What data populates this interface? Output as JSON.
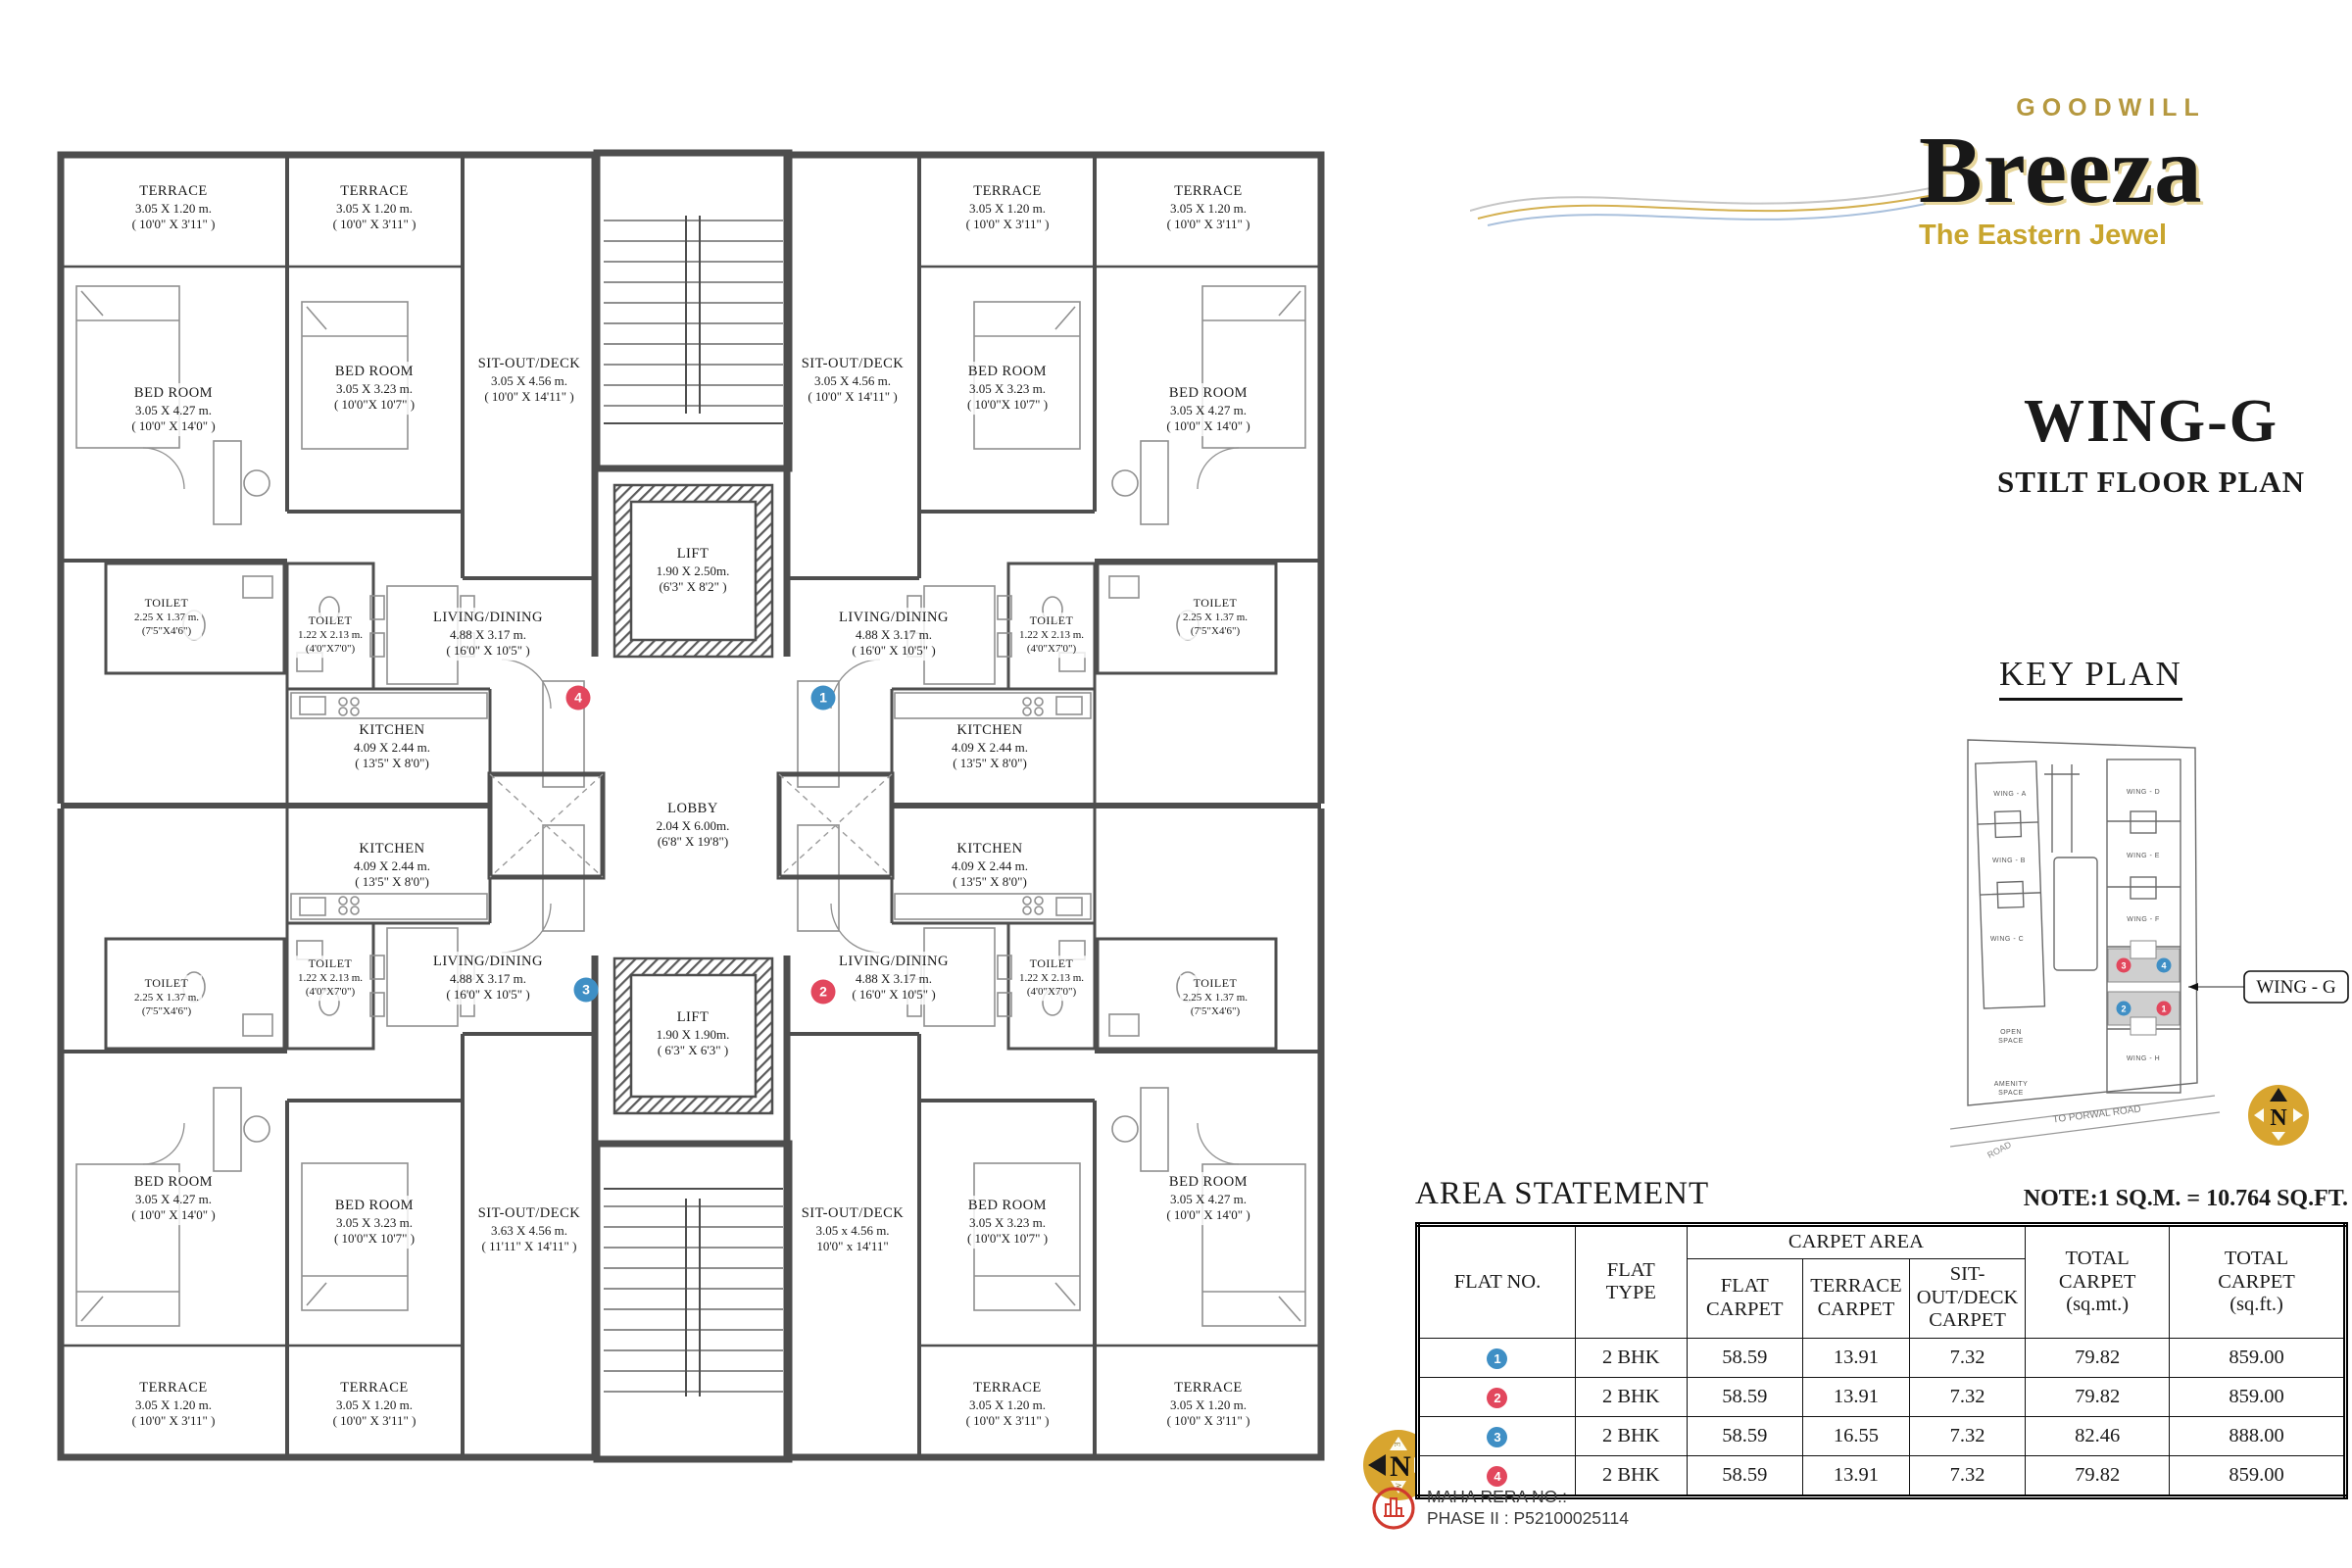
{
  "branding": {
    "goodwill": "GOODWILL",
    "name": "Breeza",
    "tagline": "The Eastern Jewel"
  },
  "titles": {
    "wing": "WING-G",
    "subtitle": "STILT FLOOR PLAN"
  },
  "key_plan": {
    "title": "KEY PLAN",
    "callout": "WING - G",
    "wings": {
      "a": "WING - A",
      "b": "WING - B",
      "c": "WING - C",
      "d": "WING - D",
      "e": "WING - E",
      "f": "WING - F",
      "h": "WING - H"
    },
    "open_space_1": "OPEN",
    "open_space_2": "SPACE",
    "amenity_1": "AMENITY",
    "amenity_2": "SPACE",
    "to_road": "TO PORWAL ROAD",
    "road": "ROAD",
    "compass_n": "N"
  },
  "floor_plan": {
    "rooms": {
      "terrace": {
        "name": "TERRACE",
        "m": "3.05 X 1.20 m.",
        "ft": "( 10'0\" X 3'11\" )"
      },
      "bedroom_l": {
        "name": "BED ROOM",
        "m": "3.05  X 4.27 m.",
        "ft": "( 10'0\" X 14'0\" )"
      },
      "bedroom_s": {
        "name": "BED ROOM",
        "m": "3.05 X 3.23 m.",
        "ft": "( 10'0\"X 10'7\" )"
      },
      "toilet_l": {
        "name": "TOILET",
        "m": "2.25 X 1.37 m.",
        "ft": "(7'5\"X4'6\")"
      },
      "toilet_s": {
        "name": "TOILET",
        "m": "1.22 X 2.13 m.",
        "ft": "(4'0\"X7'0\")"
      },
      "living": {
        "name": "LIVING/DINING",
        "m": "4.88 X 3.17 m.",
        "ft": "( 16'0\" X 10'5\" )"
      },
      "kitchen": {
        "name": "KITCHEN",
        "m": "4.09 X 2.44 m.",
        "ft": "( 13'5\" X 8'0\")"
      },
      "sitout": {
        "name": "SIT-OUT/DECK",
        "m": "3.05 X 4.56 m.",
        "ft": "( 10'0\" X 14'11\" )"
      },
      "sitout_bl": {
        "name": "SIT-OUT/DECK",
        "m": "3.63 X 4.56 m.",
        "ft": "( 11'11\" X 14'11\" )"
      },
      "sitout_br": {
        "name": "SIT-OUT/DECK",
        "m": "3.05 x 4.56 m.",
        "ft": "10'0\" x 14'11\""
      },
      "lift_top": {
        "name": "LIFT",
        "m": "1.90 X 2.50m.",
        "ft": "(6'3\" X 8'2\" )"
      },
      "lift_bot": {
        "name": "LIFT",
        "m": "1.90 X 1.90m.",
        "ft": "( 6'3\" X 6'3\" )"
      },
      "lobby": {
        "name": "LOBBY",
        "m": "2.04 X 6.00m.",
        "ft": "(6'8\" X 19'8\")"
      }
    },
    "markers": {
      "m1": "1",
      "m2": "2",
      "m3": "3",
      "m4": "4"
    },
    "compass": {
      "n": "N",
      "e": "E",
      "s": "S",
      "w": "W"
    }
  },
  "area_statement": {
    "title": "AREA STATEMENT",
    "note": "NOTE:1 SQ.M. = 10.764 SQ.FT.",
    "headers": {
      "flat_no": "FLAT NO.",
      "flat_type_1": "FLAT",
      "flat_type_2": "TYPE",
      "carpet_area": "CARPET AREA",
      "flat_carpet_1": "FLAT",
      "flat_carpet_2": "CARPET",
      "terrace_carpet_1": "TERRACE",
      "terrace_carpet_2": "CARPET",
      "sitout_carpet_1": "SIT-OUT/DECK",
      "sitout_carpet_2": "CARPET",
      "total_mt_1": "TOTAL",
      "total_mt_2": "CARPET",
      "total_mt_3": "(sq.mt.)",
      "total_ft_1": "TOTAL",
      "total_ft_2": "CARPET",
      "total_ft_3": "(sq.ft.)"
    },
    "rows": [
      {
        "no": "1",
        "type": "2 BHK",
        "flat": "58.59",
        "terrace": "13.91",
        "sitout": "7.32",
        "total_mt": "79.82",
        "total_ft": "859.00"
      },
      {
        "no": "2",
        "type": "2 BHK",
        "flat": "58.59",
        "terrace": "13.91",
        "sitout": "7.32",
        "total_mt": "79.82",
        "total_ft": "859.00"
      },
      {
        "no": "3",
        "type": "2 BHK",
        "flat": "58.59",
        "terrace": "16.55",
        "sitout": "7.32",
        "total_mt": "82.46",
        "total_ft": "888.00"
      },
      {
        "no": "4",
        "type": "2 BHK",
        "flat": "58.59",
        "terrace": "13.91",
        "sitout": "7.32",
        "total_mt": "79.82",
        "total_ft": "859.00"
      }
    ]
  },
  "rera": {
    "line1": "MAHA RERA  NO.:",
    "line2": "PHASE II : P52100025114"
  },
  "colors": {
    "marker_blue": "#3f8fc5",
    "marker_red": "#e2475d",
    "gold": "#c9a13b",
    "wall": "#4e4e4e",
    "keyplan_highlight": "#cfcfcf"
  }
}
